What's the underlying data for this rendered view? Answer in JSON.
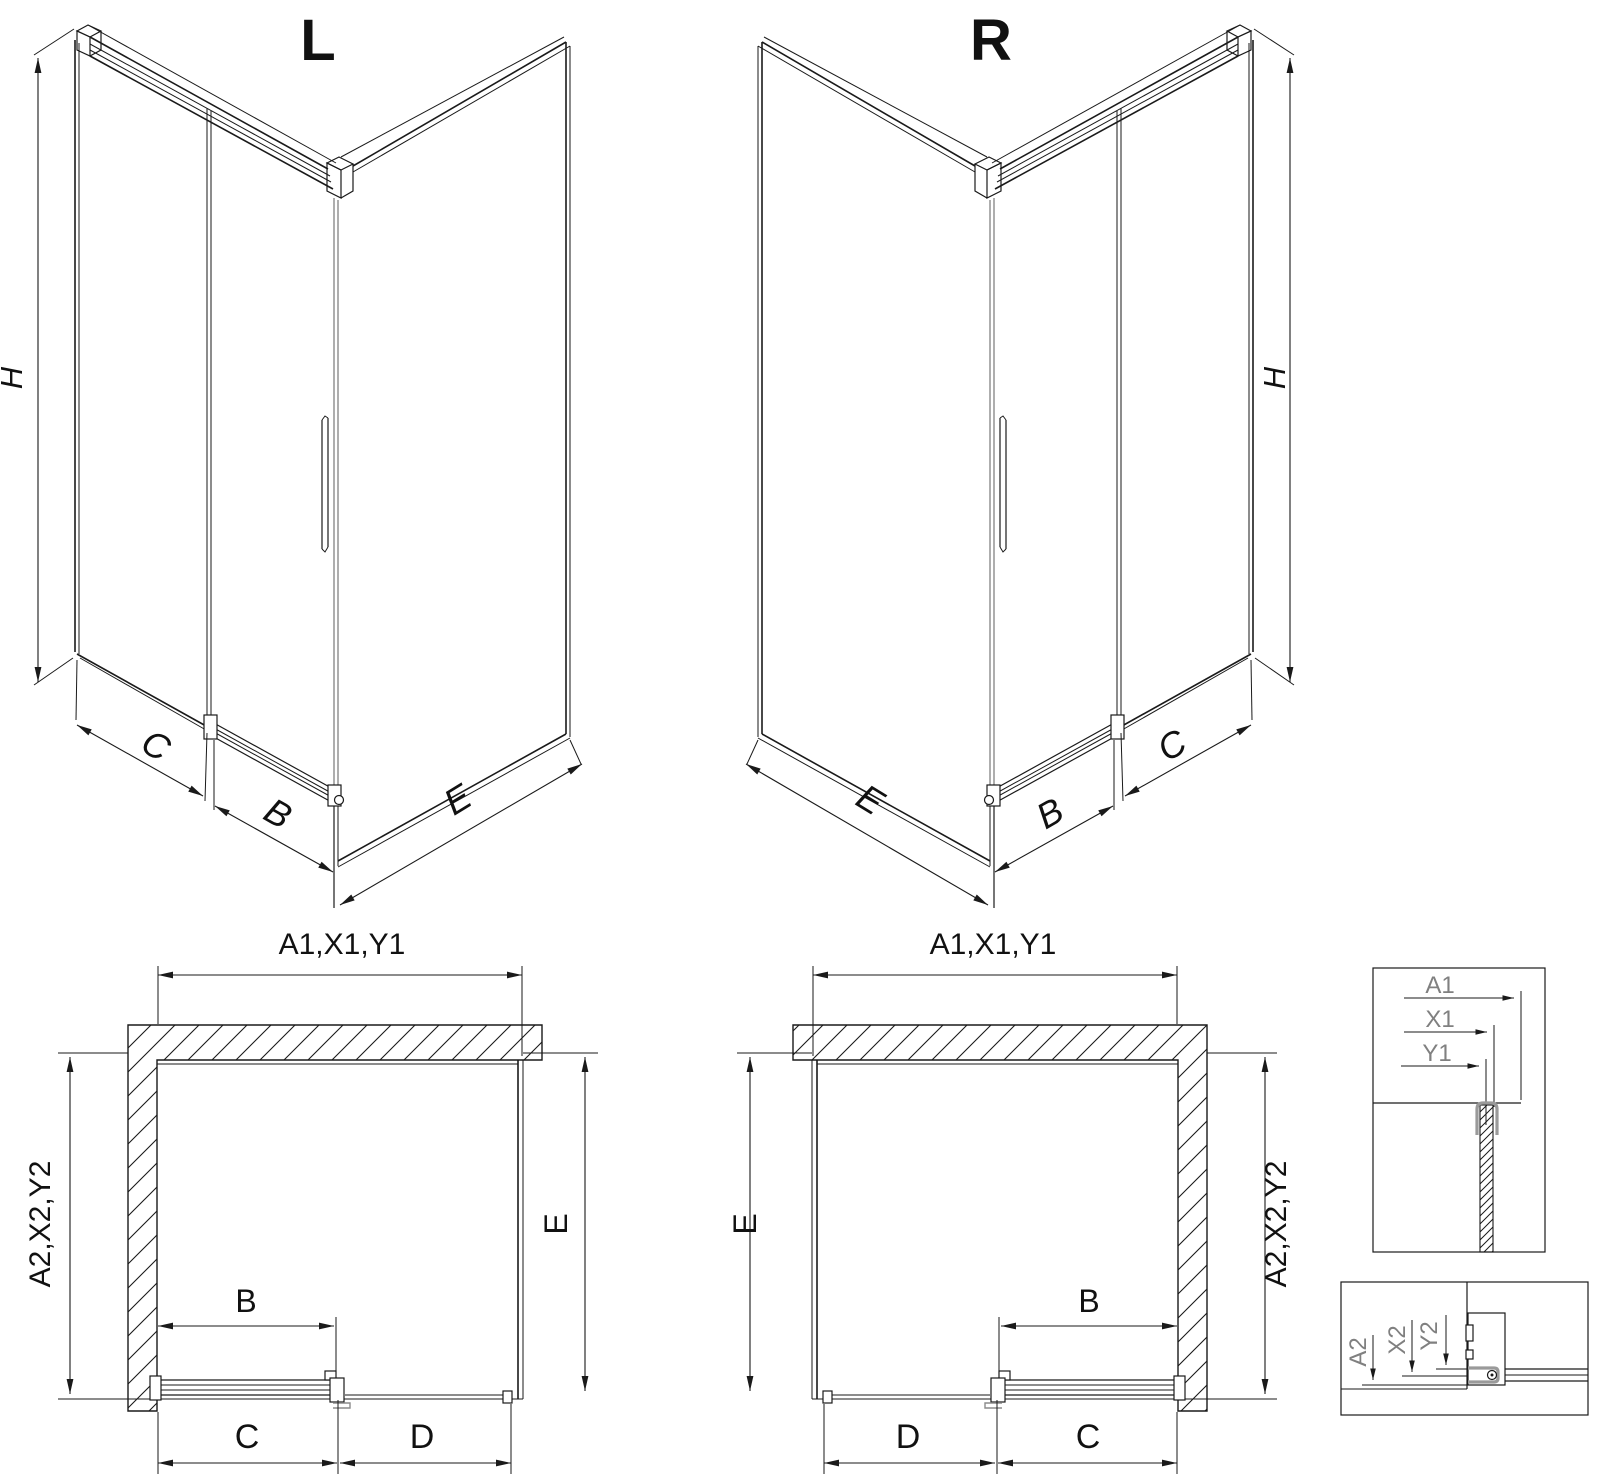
{
  "drawing": {
    "iso_left": {
      "title": "L",
      "height_label": "H",
      "side_label": "C",
      "door_label": "B",
      "return_label": "E"
    },
    "iso_right": {
      "title": "R",
      "height_label": "H",
      "side_label": "C",
      "door_label": "B",
      "return_label": "E"
    },
    "plan_left": {
      "top_label": "A1,X1,Y1",
      "left_label": "A2,X2,Y2",
      "right_label": "E",
      "door_label": "B",
      "bottom_left_label": "C",
      "bottom_right_label": "D"
    },
    "plan_right": {
      "top_label": "A1,X1,Y1",
      "left_label": "E",
      "right_label": "A2,X2,Y2",
      "door_label": "B",
      "bottom_left_label": "D",
      "bottom_right_label": "C"
    },
    "detail_top": {
      "labels": [
        "A1",
        "X1",
        "Y1"
      ]
    },
    "detail_bottom": {
      "labels": [
        "A2",
        "X2",
        "Y2"
      ]
    },
    "colors": {
      "line": "#1a1a1a",
      "grey_profile": "#8c8c8c",
      "detail_text": "#808080",
      "background": "#ffffff"
    }
  }
}
